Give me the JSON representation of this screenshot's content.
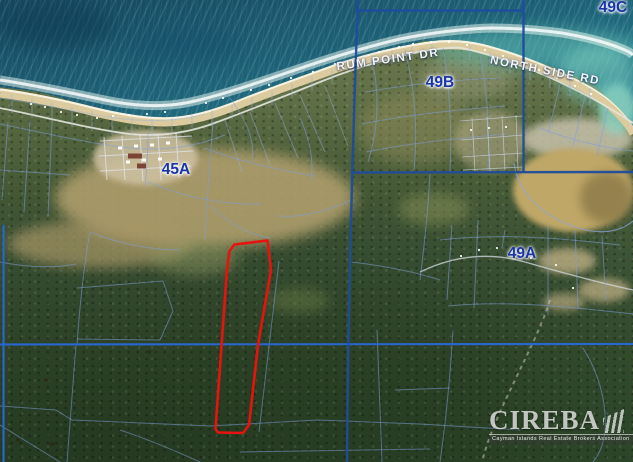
{
  "labels": {
    "blocks": [
      {
        "text": "45A",
        "x": 176,
        "y": 170
      },
      {
        "text": "49A",
        "x": 522,
        "y": 254
      },
      {
        "text": "49B",
        "x": 440,
        "y": 83
      },
      {
        "text": "49C",
        "x": 613,
        "y": 8
      }
    ],
    "roads": [
      {
        "text": "RUM POINT DR",
        "x": 388,
        "y": 60,
        "rot": -8
      },
      {
        "text": "NORTH SIDE RD",
        "x": 545,
        "y": 71,
        "rot": 11
      }
    ]
  },
  "watermark": {
    "name": "CIREBA",
    "tagline": "Cayman Islands Real Estate Brokers Association"
  },
  "colors": {
    "block_line": "#1f4c9c",
    "section_line": "#2a66cc",
    "thin_line": "rgba(128,158,216,0.55)",
    "red_parcel": "#e8120e",
    "label_navy": "#1a35a8",
    "road_label": "#ffffff"
  },
  "geometry": {
    "coast": [
      {
        "d": "M0,80 C40,86 80,95 115,102 C145,107 170,107 195,101 C225,94 260,82 295,70 C330,58 365,47 400,39 C430,33 460,29 490,28 C515,28 540,30 562,33 C585,37 605,42 620,48 C628,51 631,53 633,55",
        "s": "rgba(235,250,242,0.5)",
        "w": 9
      },
      {
        "d": "M0,80 C40,86 80,95 115,102 C145,107 170,107 195,101 C225,94 260,82 295,70 C330,58 365,47 400,39 C430,33 460,29 490,28 C515,28 540,30 562,33 C585,37 605,42 620,48 C628,51 631,53 633,55",
        "s": "rgba(255,255,255,0.8)",
        "w": 3
      },
      {
        "d": "M0,90 C30,94 60,100 95,109 C120,115 145,119 165,119 C190,119 215,111 240,101 C270,89 305,77 340,64 C375,53 410,45 440,42 C460,41 475,43 495,49 C520,56 545,66 570,78 C590,87 605,97 616,108 C626,118 630,124 633,130",
        "s": "#f7f3e2",
        "w": 3.5
      },
      {
        "d": "M0,94 C30,98 60,104 95,113 C120,119 145,123 165,123 C190,123 215,115 240,105 C270,93 305,81 340,68 C375,57 410,49 440,46 C460,45 475,47 495,53 C520,60 545,70 570,82 C590,91 605,101 616,112 C626,122 630,128 633,134",
        "s": "#dccb9e",
        "w": 7
      }
    ],
    "block_lines": [
      {
        "d": "M358,0 C352,160 348,320 347,462"
      },
      {
        "d": "M356,10.5 L523,10.5"
      },
      {
        "d": "M523.5,0 L523.5,173"
      },
      {
        "d": "M351,172.5 L633,172"
      }
    ],
    "section_lines": [
      {
        "d": "M0,344.5 L633,344"
      },
      {
        "d": "M3.5,225 L3.5,462"
      }
    ],
    "red_parcel": "M267.5,240.5 L234.5,244.5 L229.5,251 L227,270 L215.5,429 L218,432.5 L243,433 L249,425 L258,345 L271,270 Z",
    "thin_lines": [
      {
        "d": "M0,108 C45,117 90,129 130,134 C160,137 190,133 220,121 C255,108 290,94 325,80 C355,68 395,56 430,50 C445,48 455,47 462,48",
        "s": "rgba(228,230,222,0.9)",
        "w": 1.8
      },
      {
        "d": "M462,48 C505,58 545,74 578,91 C600,102 618,113 633,123",
        "s": "rgba(228,230,222,0.9)",
        "w": 1.8
      },
      {
        "d": "M12,94 L12,114 M32,98 L32,118 M52,102 L52,122 M72,107 L72,127 M92,111 L92,131 M112,115 L112,135 M132,118 L132,137 M152,119 L152,137 M172,118 L172,134 M192,115 L192,130 M212,110 L212,126 M232,104 L232,119 M252,97 L252,112 M272,90 L272,105 M292,83 L292,98 M312,76 L312,91 M332,69 L332,84 M372,55 L372,70 M392,50 L392,64 M412,46 L412,60 M432,44 L432,57 M470,46 L470,60 M490,51 L490,66 M510,57 L510,73 M530,64 L530,80 M550,71 L550,88 M570,79 L570,96 M590,88 L590,105",
        "s": "rgba(150,178,226,0.5)",
        "w": 1
      },
      {
        "d": "M0,124 C45,133 90,144 130,148 C165,151 195,147 225,135"
      },
      {
        "d": "M0,98 C40,104 80,112 115,118 C145,122 175,122 205,114",
        "s": "rgba(150,178,226,0.45)"
      },
      {
        "d": "M100,141 L192,136",
        "s": "rgba(222,226,234,0.8)"
      },
      {
        "d": "M99,156 L193,151",
        "s": "rgba(222,226,234,0.8)"
      },
      {
        "d": "M100,171 L191,166",
        "s": "rgba(222,226,234,0.8)"
      },
      {
        "d": "M104,137 L107,180",
        "s": "rgba(222,226,234,0.8)"
      },
      {
        "d": "M122,136 L125,180",
        "s": "rgba(222,226,234,0.8)"
      },
      {
        "d": "M140,135 L143,181",
        "s": "rgba(222,226,234,0.8)"
      },
      {
        "d": "M158,134 L161,180",
        "s": "rgba(222,226,234,0.8)"
      },
      {
        "d": "M176,133 L179,178",
        "s": "rgba(222,226,234,0.8)"
      },
      {
        "d": "M148,133 C148,152 147,170 145,186"
      },
      {
        "d": "M372,60 C380,95 378,130 368,162"
      },
      {
        "d": "M405,50 C415,90 418,130 414,170"
      },
      {
        "d": "M443,48 C450,90 452,132 450,172"
      },
      {
        "d": "M480,55 C488,95 490,135 488,172"
      },
      {
        "d": "M365,92 C405,85 450,80 500,78"
      },
      {
        "d": "M362,124 C405,115 455,110 505,106"
      },
      {
        "d": "M366,152 C410,143 460,138 508,134"
      },
      {
        "d": "M460,121 L523,116",
        "s": "rgba(200,208,224,0.75)",
        "w": 0.8
      },
      {
        "d": "M461,140 L523,135",
        "s": "rgba(200,208,224,0.75)",
        "w": 0.8
      },
      {
        "d": "M462,157 L523,153",
        "s": "rgba(200,208,224,0.75)",
        "w": 0.8
      },
      {
        "d": "M463,170 L523,167",
        "s": "rgba(200,208,224,0.75)",
        "w": 0.8
      },
      {
        "d": "M472,118 L475,171",
        "s": "rgba(200,208,224,0.75)",
        "w": 0.8
      },
      {
        "d": "M487,117 L490,171",
        "s": "rgba(200,208,224,0.75)",
        "w": 0.8
      },
      {
        "d": "M502,116 L505,170",
        "s": "rgba(200,208,224,0.75)",
        "w": 0.8
      },
      {
        "d": "M516,115 L518,170",
        "s": "rgba(200,208,224,0.75)",
        "w": 0.8
      },
      {
        "d": "M560,85 L548,133"
      },
      {
        "d": "M585,96 L573,146"
      },
      {
        "d": "M608,108 L597,156"
      },
      {
        "d": "M540,128 C570,140 600,147 633,151"
      },
      {
        "d": "M514,163 C518,192 540,214 572,226 C600,236 620,232 633,221",
        "s": "rgba(140,165,220,0.7)",
        "w": 1.2
      },
      {
        "d": "M420,272 C455,255 490,252 525,262 C560,272 600,283 633,290",
        "s": "rgba(215,220,228,0.75)",
        "w": 1.4
      },
      {
        "d": "M452,225 L447,300"
      },
      {
        "d": "M478,220 L474,308"
      },
      {
        "d": "M505,230 L502,248"
      },
      {
        "d": "M548,225 L548,315"
      },
      {
        "d": "M575,230 L578,308"
      },
      {
        "d": "M602,236 L606,300"
      },
      {
        "d": "M430,174 C428,210 424,248 420,280"
      },
      {
        "d": "M440,240 C500,233 560,238 620,245"
      },
      {
        "d": "M448,306 C510,300 570,307 633,314"
      },
      {
        "d": "M205,148 C240,162 280,170 315,176"
      },
      {
        "d": "M230,98 C248,122 255,142 252,162"
      },
      {
        "d": "M148,182 C185,198 225,205 262,204"
      },
      {
        "d": "M300,118 C310,140 314,160 311,180"
      },
      {
        "d": "M352,200 C325,212 300,218 278,216"
      },
      {
        "d": "M210,205 C230,225 250,235 270,238"
      },
      {
        "d": "M90,232 C120,244 150,250 180,250"
      },
      {
        "d": "M213,122 C210,160 207,200 205,240"
      },
      {
        "d": "M225,120 L242,172 M250,112 L270,165 M275,103 L298,158 M300,95 L325,152 M325,86 L348,146",
        "s": "rgba(150,178,226,0.45)"
      },
      {
        "d": "M8,122 L2,200"
      },
      {
        "d": "M30,120 L24,212"
      },
      {
        "d": "M52,122 L48,216"
      },
      {
        "d": "M0,170 L70,175"
      },
      {
        "d": "M90,233 C86,250 80,300 77,345"
      },
      {
        "d": "M76,345 L67,462"
      },
      {
        "d": "M77,288 L163,281 L173,311 L160,340"
      },
      {
        "d": "M77,339 L160,340"
      },
      {
        "d": "M0,406 L56,410 L72,420 L210,426 L318,420 L420,424 L520,430"
      },
      {
        "d": "M240,452 L430,449"
      },
      {
        "d": "M279,261 L259,432"
      },
      {
        "d": "M377,330 L382,462"
      },
      {
        "d": "M352,262 C385,266 415,272 440,280"
      },
      {
        "d": "M0,262 C30,268 55,268 76,264"
      },
      {
        "d": "M453,330 C450,380 446,420 440,462"
      },
      {
        "d": "M550,300 C540,332 518,372 500,412 C492,430 486,446 482,462",
        "s": "rgba(215,210,185,0.5)",
        "w": 2,
        "da": "4,4"
      },
      {
        "d": "M583,348 C600,375 607,405 605,432 C603,447 598,456 593,462"
      },
      {
        "d": "M395,390 L450,388"
      },
      {
        "d": "M0,425 L60,462"
      },
      {
        "d": "M120,430 C150,440 178,452 200,462"
      },
      {
        "d": "M96,118h2M112,116h2M128,115h2M146,114h2M164,112h2M60,112h2M76,115h2M30,104h2M44,107h2M205,103h2M222,98h2M250,90h2M268,85h2M290,78h2M312,72h2M334,64h2M356,58h2M378,52h2M398,47h2M412,44h2M430,42h2M448,42h2M466,45h2M484,50h2M502,56h2M520,63h2M538,70h2M556,78h2M574,86h2M590,94h2M460,256h2M478,250h2M496,248h2M512,252h2M530,258h2M470,130h2M488,128h2M505,127h2M555,265h2M572,288h2",
        "s": "rgba(255,255,255,0.85)",
        "w": 2
      },
      {
        "d": "M118,148h4M134,146h4M150,145h4M166,143h4M126,162h4M142,160h4M158,159h4",
        "s": "rgba(255,255,255,0.95)",
        "w": 3
      },
      {
        "d": "M128,156h14M137,166h9",
        "s": "#7c4434",
        "w": 5
      },
      {
        "d": "M44,380h4M50,444h5M16,440h4M148,352h3M250,392h3",
        "s": "rgba(42,40,22,0.8)",
        "w": 3
      }
    ]
  },
  "patches": [
    {
      "x": 55,
      "y": 148,
      "w": 300,
      "h": 100,
      "c": "#b2a06e",
      "o": 0.88,
      "b": 7
    },
    {
      "x": 8,
      "y": 220,
      "w": 185,
      "h": 48,
      "c": "#a99767",
      "o": 0.7,
      "b": 6
    },
    {
      "x": 150,
      "y": 240,
      "w": 90,
      "h": 35,
      "c": "#8f9761",
      "o": 0.5,
      "b": 7
    },
    {
      "x": 358,
      "y": 92,
      "w": 115,
      "h": 72,
      "c": "#99925f",
      "o": 0.45,
      "b": 8
    },
    {
      "x": 93,
      "y": 130,
      "w": 105,
      "h": 55,
      "c": "#cfc2a2",
      "o": 0.85,
      "b": 3
    },
    {
      "x": 522,
      "y": 118,
      "w": 111,
      "h": 42,
      "c": "#c8c2ac",
      "o": 0.85,
      "b": 4
    },
    {
      "x": 513,
      "y": 148,
      "w": 120,
      "h": 84,
      "c": "#bfa767",
      "o": 1,
      "b": 3
    },
    {
      "x": 580,
      "y": 172,
      "w": 53,
      "h": 52,
      "c": "#8a7847",
      "o": 0.8,
      "b": 5
    },
    {
      "x": 598,
      "y": 84,
      "w": 38,
      "h": 50,
      "c": "#8fd2c0",
      "o": 0.85,
      "b": 4
    },
    {
      "x": 538,
      "y": 248,
      "w": 58,
      "h": 26,
      "c": "#c6b488",
      "o": 0.75,
      "b": 4
    },
    {
      "x": 578,
      "y": 278,
      "w": 52,
      "h": 24,
      "c": "#c6b488",
      "o": 0.7,
      "b": 4
    },
    {
      "x": 543,
      "y": 293,
      "w": 42,
      "h": 18,
      "c": "#bfae84",
      "o": 0.65,
      "b": 4
    },
    {
      "x": 398,
      "y": 193,
      "w": 72,
      "h": 32,
      "c": "#8a9458",
      "o": 0.5,
      "b": 6
    },
    {
      "x": 268,
      "y": 288,
      "w": 62,
      "h": 25,
      "c": "#6d8048",
      "o": 0.45,
      "b": 6
    },
    {
      "x": 0,
      "y": 2,
      "w": 115,
      "h": 48,
      "c": "#0d3c54",
      "o": 0.55,
      "b": 9
    },
    {
      "x": 128,
      "y": 28,
      "w": 115,
      "h": 36,
      "c": "#12506a",
      "o": 0.45,
      "b": 9
    },
    {
      "x": 418,
      "y": 58,
      "w": 95,
      "h": 42,
      "c": "#a5a584",
      "o": 0.4,
      "b": 6
    },
    {
      "x": 455,
      "y": 110,
      "w": 72,
      "h": 62,
      "c": "#b5ac88",
      "o": 0.55,
      "b": 4
    },
    {
      "x": 428,
      "y": 28,
      "w": 215,
      "h": 42,
      "c": "#66c2b4",
      "o": 0.5,
      "b": 8
    },
    {
      "x": 558,
      "y": 46,
      "w": 78,
      "h": 58,
      "c": "#7accbe",
      "o": 0.55,
      "b": 7
    }
  ]
}
